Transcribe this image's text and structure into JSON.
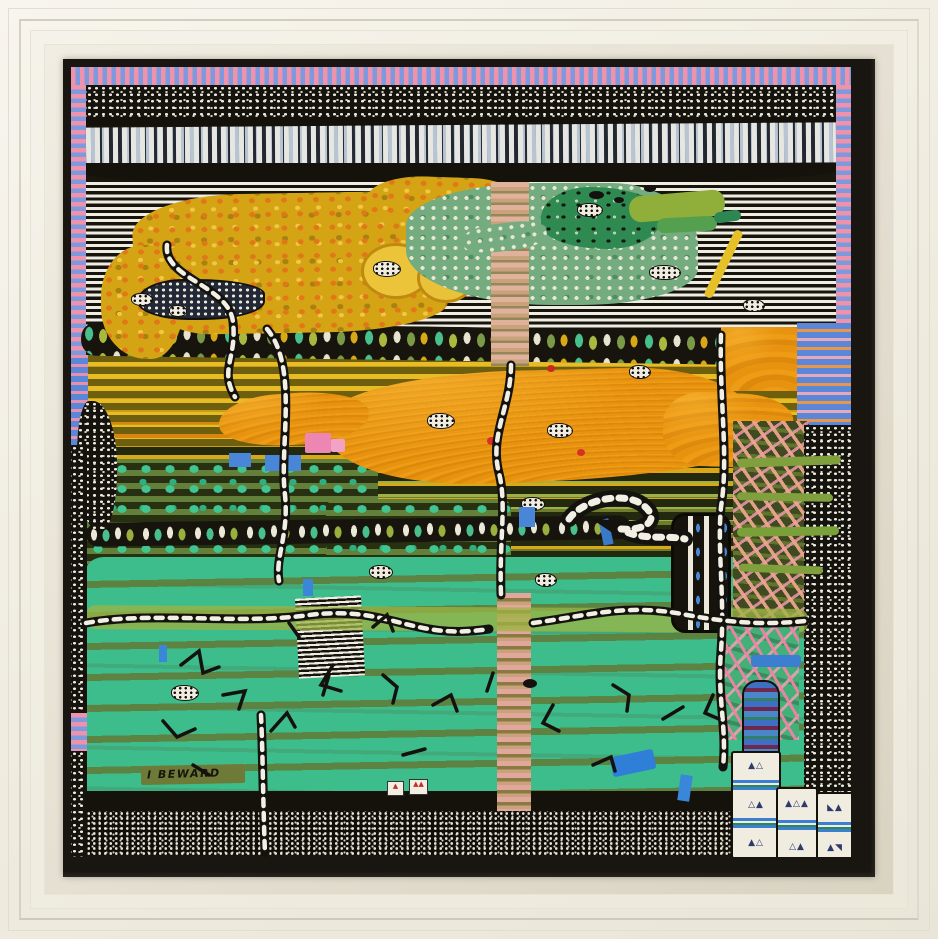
{
  "artwork": {
    "signature": "I BEWARD",
    "description": "framed naive landscape painting with dotted and striped patterns",
    "palette": {
      "frame_cream": "#f1ede2",
      "frame_lip_black": "#191510",
      "border_pink": "#ef93ad",
      "border_blue": "#7e99dc",
      "mustard": "#d4a414",
      "orange": "#e8930f",
      "olive": "#6e7c2e",
      "teal_green": "#3dbd8c",
      "island_green": "#74ac80",
      "near_black": "#15130e",
      "dot_white": "#eee9dc",
      "accent_blue": "#4a86d8",
      "accent_pink": "#ee86b4",
      "accent_red": "#d83026"
    }
  },
  "scene": {
    "layers": [
      {
        "n": "canvas-base",
        "b": [
          0,
          0,
          780,
          790
        ],
        "bg": "#1a160e"
      },
      {
        "n": "border-stripes-top",
        "b": [
          0,
          0,
          780,
          18
        ],
        "cls": "sv"
      },
      {
        "n": "border-stripes-left",
        "b": [
          0,
          18,
          15,
          364
        ],
        "cls": "sh"
      },
      {
        "n": "border-stripes-right",
        "b": [
          765,
          18,
          15,
          348
        ],
        "cls": "sh"
      },
      {
        "n": "dot-band",
        "b": [
          15,
          18,
          750,
          33
        ],
        "cls": "dots"
      },
      {
        "n": "black-line",
        "b": [
          15,
          50,
          750,
          9
        ],
        "bg": "#14110b"
      },
      {
        "n": "brick-band",
        "b": [
          15,
          58,
          750,
          40
        ],
        "cls": "bricks",
        "rot": -0.4
      },
      {
        "n": "black-band",
        "b": [
          15,
          96,
          750,
          21
        ],
        "bg": "#15120c",
        "r": "0 0 40% 30%/0 0 14px 10px"
      },
      {
        "n": "stripe-zone",
        "b": [
          15,
          115,
          750,
          170
        ],
        "cls": "hstripes"
      },
      {
        "n": "yellow-dash-band",
        "b": [
          15,
          288,
          750,
          104
        ],
        "cls": "ydash"
      },
      {
        "n": "olive-dash-band",
        "b": [
          15,
          380,
          750,
          126
        ],
        "cls": "odash"
      },
      {
        "n": "teal-dot-field-a",
        "b": [
          15,
          392,
          292,
          110
        ],
        "cls": "tealdots",
        "r": "10px"
      },
      {
        "n": "teal-dot-field-b",
        "b": [
          255,
          432,
          185,
          72
        ],
        "cls": "tealdots",
        "r": "10px"
      },
      {
        "n": "teal-meadow",
        "b": [
          15,
          490,
          722,
          240
        ],
        "cls": "teal",
        "r": "18px 30px 0 0/14px 22px 0 0"
      },
      {
        "n": "bottom-black-band",
        "b": [
          15,
          724,
          750,
          22
        ],
        "bg": "#15120b"
      },
      {
        "n": "checker-band",
        "b": [
          15,
          744,
          750,
          44
        ],
        "cls": "checker"
      },
      {
        "n": "bead-band-upper",
        "b": [
          10,
          260,
          762,
          34
        ],
        "cls": "beads",
        "rot": 0.8,
        "r": "16px"
      },
      {
        "n": "orange-band-main",
        "b": [
          255,
          303,
          432,
          112
        ],
        "cls": "orange",
        "r": "45% 30% 60% 35%/40% 55% 30% 50%",
        "rot": -1.5
      },
      {
        "n": "orange-tongue",
        "b": [
          148,
          326,
          150,
          52
        ],
        "cls": "orange",
        "r": "40% 50% 45% 50%/50% 45% 50% 45%",
        "rot": -4
      },
      {
        "n": "orange-arm",
        "b": [
          592,
          326,
          130,
          74
        ],
        "cls": "orange",
        "rot": 2,
        "r": "30% 40% 45% 30%/40% 35% 40% 45%"
      },
      {
        "n": "orange-block-right",
        "b": [
          650,
          260,
          78,
          64
        ],
        "cls": "orange"
      },
      {
        "n": "blue-stripe-block",
        "b": [
          726,
          256,
          56,
          106
        ],
        "cls": "bluestripe"
      },
      {
        "n": "pink-dash-zone",
        "b": [
          662,
          354,
          76,
          204
        ],
        "cls": "salmon"
      },
      {
        "n": "right-dot-border",
        "b": [
          733,
          358,
          47,
          388
        ],
        "cls": "dots"
      },
      {
        "n": "green-bar-1",
        "b": [
          666,
          390,
          104,
          9
        ],
        "bg": "#7fa03c",
        "rot": -2,
        "r": "5px"
      },
      {
        "n": "green-bar-2",
        "b": [
          666,
          426,
          96,
          8
        ],
        "bg": "#7fa03c",
        "rot": 1,
        "r": "5px"
      },
      {
        "n": "green-bar-3",
        "b": [
          666,
          460,
          102,
          9
        ],
        "bg": "#7aa03a",
        "rot": -1,
        "r": "5px"
      },
      {
        "n": "green-bar-4",
        "b": [
          668,
          498,
          84,
          8
        ],
        "bg": "#7fa03c",
        "rot": 2,
        "r": "5px"
      },
      {
        "n": "bead-band-lower",
        "b": [
          15,
          452,
          545,
          24
        ],
        "cls": "beads2",
        "rot": -0.8,
        "r": "12px"
      },
      {
        "n": "plateau-main",
        "b": [
          62,
          126,
          314,
          140
        ],
        "cls": "plateau",
        "r": "35% 18% 40% 25%/28% 38% 20% 45%",
        "rot": -1
      },
      {
        "n": "plateau-arm",
        "b": [
          296,
          110,
          150,
          48
        ],
        "cls": "plateau",
        "rot": 2,
        "r": "40% 30% 35% 45%/50% 40% 45% 35%"
      },
      {
        "n": "plateau-lobe",
        "b": [
          30,
          178,
          84,
          114
        ],
        "cls": "plateau",
        "r": "50% 45% 40% 55%/45% 40% 55% 45%"
      },
      {
        "n": "bright-lobe-1",
        "b": [
          290,
          176,
          64,
          50
        ],
        "bg": "#ecc43a",
        "r": "50%",
        "bd": "3px solid #c08a10"
      },
      {
        "n": "bright-lobe-2",
        "b": [
          346,
          186,
          52,
          44
        ],
        "bg": "#eac23a",
        "r": "50%",
        "bd": "3px solid #c08a10"
      },
      {
        "n": "green-island",
        "b": [
          335,
          116,
          292,
          122
        ],
        "cls": "island",
        "r": "45% 30% 40% 50%/35% 50% 30% 45%"
      },
      {
        "n": "green-island-dark",
        "b": [
          470,
          120,
          122,
          62
        ],
        "cls": "darkisland",
        "r": "40% 60% 45% 55%/50% 45% 55% 40%"
      },
      {
        "n": "islet-1",
        "b": [
          558,
          126,
          96,
          26
        ],
        "bg": "#8fae3a",
        "rot": -5,
        "r": "12px"
      },
      {
        "n": "islet-2",
        "b": [
          586,
          150,
          60,
          15
        ],
        "bg": "#55a04e",
        "rot": -3,
        "r": "8px"
      },
      {
        "n": "islet-3",
        "b": [
          643,
          144,
          27,
          11
        ],
        "bg": "#2e8653",
        "rot": -8,
        "r": "6px"
      },
      {
        "n": "yellow-streak",
        "b": [
          648,
          160,
          9,
          74
        ],
        "bg": "#e6c028",
        "rot": 26,
        "r": "4px"
      },
      {
        "n": "tan-ladder-column",
        "b": [
          420,
          115,
          38,
          184
        ],
        "cls": "tan"
      },
      {
        "n": "island-wedge",
        "b": [
          392,
          156,
          84,
          28
        ],
        "cls": "island",
        "rot": -7,
        "r": "40%"
      },
      {
        "n": "dotted-lake",
        "b": [
          66,
          212,
          124,
          37
        ],
        "cls": "lake",
        "r": "40% 60% 55% 45%/60% 40% 50% 50%"
      },
      {
        "n": "pink-ladder-column",
        "b": [
          426,
          526,
          34,
          218
        ],
        "cls": "pinkladder"
      },
      {
        "n": "striped-patch",
        "b": [
          226,
          530,
          66,
          80
        ],
        "cls": "hstripes-sm",
        "rot": -3
      },
      {
        "n": "light-olive-band",
        "b": [
          15,
          540,
          722,
          24
        ],
        "bg": "#9cb444",
        "op": 0.75,
        "r": "10px",
        "rot": 0.3
      },
      {
        "n": "black-panel",
        "b": [
          600,
          446,
          54,
          114
        ],
        "cls": "panel",
        "r": "14px"
      },
      {
        "n": "bluepink-left-patch",
        "b": [
          0,
          288,
          17,
          102
        ],
        "cls": "bluepink"
      },
      {
        "n": "left-dot-blob",
        "b": [
          6,
          334,
          40,
          130
        ],
        "cls": "dots",
        "r": "30% 60% 40% 55%/40% 50% 45% 50%"
      },
      {
        "n": "left-dot-column",
        "b": [
          0,
          378,
          16,
          412
        ],
        "cls": "dots"
      },
      {
        "n": "left-pink-bit",
        "b": [
          0,
          646,
          16,
          38
        ],
        "cls": "sh"
      },
      {
        "n": "green-pinkdash-zone",
        "b": [
          648,
          551,
          80,
          122
        ],
        "cls": "greenfield"
      },
      {
        "n": "blue-bar",
        "b": [
          680,
          588,
          50,
          12
        ],
        "bg": "#3a7fd0",
        "r": "3px"
      },
      {
        "n": "arch-column",
        "b": [
          671,
          613,
          34,
          80
        ],
        "cls": "arch"
      },
      {
        "n": "dot-blob",
        "b": [
          302,
          194,
          26,
          14
        ],
        "cls": "dotblob"
      },
      {
        "n": "dot-blob",
        "b": [
          506,
          136,
          24,
          12
        ],
        "cls": "dotblob"
      },
      {
        "n": "dot-blob",
        "b": [
          578,
          198,
          30,
          13
        ],
        "cls": "dotblob"
      },
      {
        "n": "dot-blob",
        "b": [
          60,
          226,
          20,
          11
        ],
        "cls": "dotblob"
      },
      {
        "n": "dot-blob",
        "b": [
          98,
          238,
          16,
          10
        ],
        "cls": "dotblob"
      },
      {
        "n": "dot-blob",
        "b": [
          356,
          346,
          26,
          14
        ],
        "cls": "dotblob"
      },
      {
        "n": "dot-blob",
        "b": [
          476,
          356,
          24,
          13
        ],
        "cls": "dotblob"
      },
      {
        "n": "dot-blob",
        "b": [
          558,
          298,
          20,
          12
        ],
        "cls": "dotblob"
      },
      {
        "n": "dot-blob",
        "b": [
          450,
          430,
          22,
          12
        ],
        "cls": "dotblob"
      },
      {
        "n": "dot-blob",
        "b": [
          464,
          506,
          20,
          12
        ],
        "cls": "dotblob"
      },
      {
        "n": "dot-blob",
        "b": [
          298,
          498,
          22,
          12
        ],
        "cls": "dotblob"
      },
      {
        "n": "dot-blob",
        "b": [
          100,
          618,
          26,
          14
        ],
        "cls": "dotblob"
      },
      {
        "n": "dot-blob",
        "b": [
          672,
          232,
          20,
          11
        ],
        "cls": "dotblob"
      },
      {
        "n": "black-blob",
        "b": [
          518,
          124,
          15,
          8
        ],
        "bg": "#14110e",
        "r": "50%"
      },
      {
        "n": "black-blob",
        "b": [
          543,
          130,
          10,
          6
        ],
        "bg": "#14110e",
        "r": "50%"
      },
      {
        "n": "black-blob",
        "b": [
          573,
          118,
          12,
          7
        ],
        "bg": "#14110e",
        "r": "50%"
      },
      {
        "n": "black-blob",
        "b": [
          452,
          612,
          14,
          9
        ],
        "bg": "#14110e",
        "r": "50%"
      },
      {
        "n": "pink-square",
        "b": [
          234,
          366,
          26,
          20
        ],
        "bg": "#ee86b4",
        "r": "2px"
      },
      {
        "n": "pink-square",
        "b": [
          260,
          372,
          14,
          13
        ],
        "bg": "#f2a2c4",
        "r": "2px"
      },
      {
        "n": "blue-square",
        "b": [
          158,
          386,
          22,
          14
        ],
        "bg": "#4a86d8"
      },
      {
        "n": "blue-square",
        "b": [
          194,
          388,
          36,
          16
        ],
        "bg": "#4a86d8"
      },
      {
        "n": "blue-square",
        "b": [
          448,
          440,
          16,
          20
        ],
        "bg": "#4a86d8"
      },
      {
        "n": "blue-tick",
        "b": [
          530,
          452,
          10,
          26
        ],
        "bg": "#3a78c8",
        "rot": -12
      },
      {
        "n": "red-dot",
        "b": [
          416,
          370,
          9,
          8
        ],
        "bg": "#d83026",
        "r": "50%"
      },
      {
        "n": "red-dot",
        "b": [
          506,
          382,
          8,
          7
        ],
        "bg": "#d83026",
        "r": "50%"
      },
      {
        "n": "red-dot",
        "b": [
          476,
          298,
          8,
          7
        ],
        "bg": "#c82820",
        "r": "50%"
      },
      {
        "n": "blue-pond",
        "b": [
          540,
          686,
          44,
          20
        ],
        "bg": "#2f7fd8",
        "rot": -12,
        "r": "3px"
      },
      {
        "n": "blue-tick",
        "b": [
          608,
          708,
          12,
          26
        ],
        "bg": "#3a86d8",
        "rot": 8
      },
      {
        "n": "blue-tick",
        "b": [
          232,
          512,
          10,
          17
        ],
        "bg": "#3a86d8"
      },
      {
        "n": "blue-tick",
        "b": [
          88,
          578,
          8,
          17
        ],
        "bg": "#3a86d8"
      },
      {
        "n": "signature-bar",
        "b": [
          70,
          698,
          104,
          19
        ],
        "bg": "#6e7a38",
        "rot": -1.2,
        "r": "2px"
      },
      {
        "n": "artist-signature",
        "b": [
          76,
          699,
          110,
          18
        ],
        "rot": -1.5,
        "bind": "artwork.signature"
      }
    ],
    "svg": {
      "roads": [
        "M96,178 C92,212 158,218 162,255 C166,292 148,302 164,330",
        "M440,298 C440,340 418,368 428,406 C436,438 428,472 430,528",
        "M650,268 C648,330 658,390 650,440 C646,482 654,530 650,584 C646,630 656,660 652,700",
        "M196,262 C228,300 208,380 214,428 C218,468 204,490 208,514",
        "M15,556 C80,544 170,558 238,548 C320,538 340,574 418,562",
        "M462,556 C520,548 558,536 616,548 C660,556 694,558 734,554",
        "M190,648 C192,690 192,740 194,786"
      ],
      "snake": "M498,452 C512,432 554,424 572,438 C590,452 576,464 550,462 C568,474 598,468 614,472",
      "squiggles": [
        "M110,598 l18,-14 l4,22 l16,-6",
        "M152,628 l22,-4 l-6,18",
        "M92,654 l14,16 l18,-8",
        "M200,664 l16,-18 l8,14",
        "M262,598 l-12,20 l20,6",
        "M312,608 l14,12 l-4,16",
        "M362,638 l18,-10 l6,16",
        "M332,688 l22,-6",
        "M482,638 l-10,18 l16,8",
        "M542,618 l16,10 l-2,16",
        "M592,652 l20,-12",
        "M642,628 l-8,18 l14,6",
        "M522,698 l18,-8 l4,14",
        "M122,698 l16,10",
        "M252,628 l6,-20",
        "M422,606 l-6,18",
        "M302,560 l14,-12 l6,16",
        "M218,556 l10,14"
      ]
    },
    "towers": [
      {
        "b": [
          660,
          684,
          46,
          104
        ],
        "rows": [
          "▲△",
          "S",
          "△▲",
          "S",
          "▲△"
        ]
      },
      {
        "b": [
          705,
          720,
          38,
          74
        ],
        "rows": [
          "▲△▲",
          "S",
          "△▲"
        ]
      },
      {
        "b": [
          745,
          725,
          34,
          68
        ],
        "rows": [
          "◣▲",
          "S",
          "▲◥"
        ]
      }
    ],
    "tags": [
      {
        "b": [
          316,
          714,
          15,
          13
        ],
        "chars": "▲"
      },
      {
        "b": [
          338,
          712,
          17,
          14
        ],
        "chars": "▲▲"
      }
    ]
  }
}
